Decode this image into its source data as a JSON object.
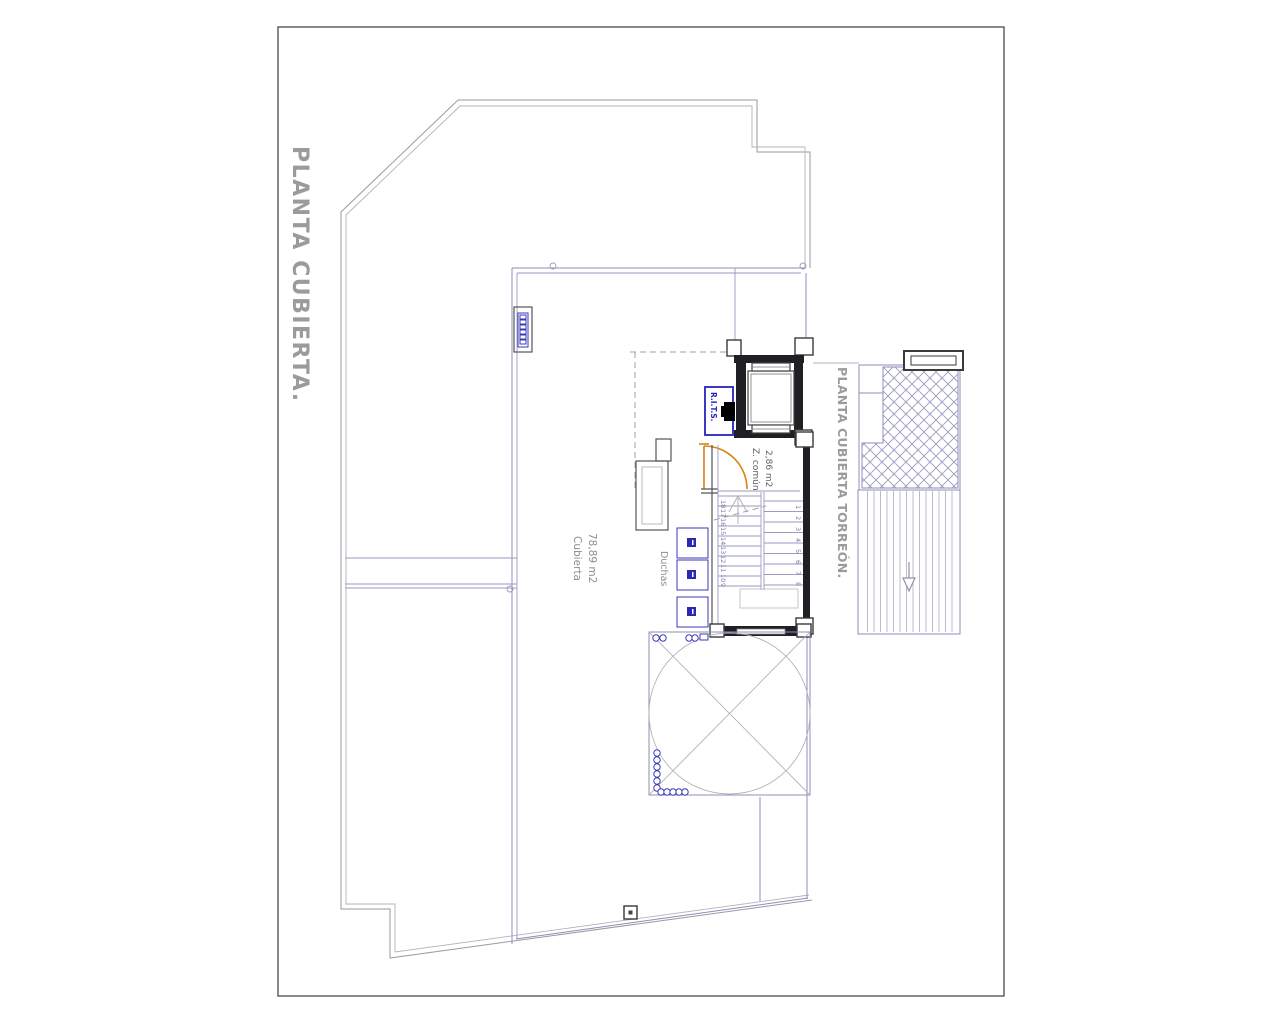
{
  "drawing": {
    "title_main": "PLANTA CUBIERTA.",
    "title_torreon": "PLANTA CUBIERTA TORREÓN.",
    "roof_label": "Cubierta",
    "roof_area": "78,89 m2",
    "common_label": "Z. común",
    "common_area": "2,86 m2",
    "showers_label": "Duchas",
    "rits_label": "R.I.T.S.",
    "stair_left_numbers": [
      "18",
      "17",
      "16",
      "15",
      "14",
      "13",
      "12",
      "11",
      "10",
      "9"
    ],
    "stair_right_numbers": [
      "1",
      "2",
      "3",
      "4",
      "5",
      "6",
      "7",
      "8"
    ],
    "colors": {
      "terrace_outline": "#9a9aa2",
      "roof_lines": "#8d8dbb",
      "walls": "#1f1f24",
      "door": "#d5850f",
      "rits_blue": "#2424bb",
      "titles": "#9b9b9b",
      "labels": "#8e8e92"
    }
  }
}
